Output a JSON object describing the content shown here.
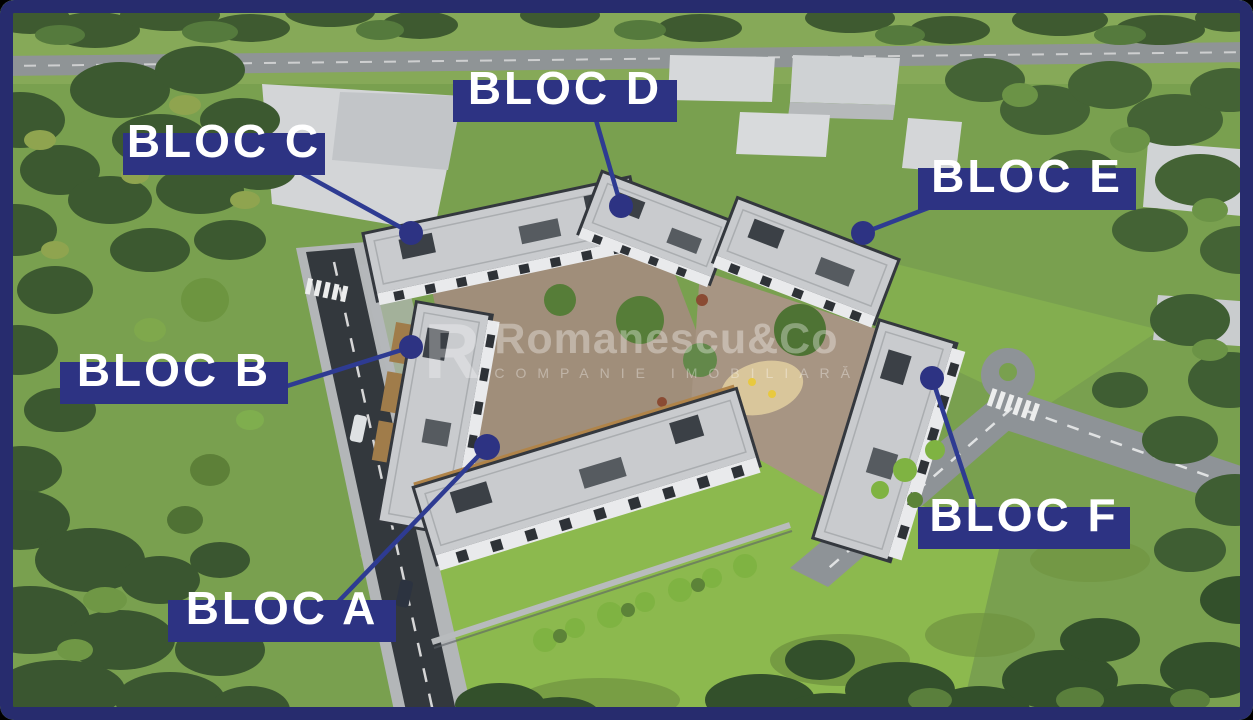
{
  "image_type": "aerial-3d-render-of-residential-complex",
  "labels": [
    {
      "id": "bloc-c",
      "text": "BLOC C"
    },
    {
      "id": "bloc-d",
      "text": "BLOC D"
    },
    {
      "id": "bloc-e",
      "text": "BLOC E"
    },
    {
      "id": "bloc-b",
      "text": "BLOC B"
    },
    {
      "id": "bloc-a",
      "text": "BLOC A"
    },
    {
      "id": "bloc-f",
      "text": "BLOC F"
    }
  ],
  "watermark": {
    "logo_letter": "R",
    "brand": "Romanescu&Co",
    "tagline": "COMPANIE IMOBILIARĂ"
  },
  "colors": {
    "annotation_navy": "#2d3383",
    "frame_navy": "#272c6e",
    "leader_line_blue": "#2e3b92",
    "grass_base": "#79a04f",
    "lawn_bright": "#8cb94e",
    "asphalt_dark": "#33383d",
    "asphalt_light": "#8e9397",
    "roof_light": "#c9cbce",
    "wall_charcoal": "#34383e",
    "facade_white": "#e9eaec",
    "wood_accent": "#b08449"
  }
}
